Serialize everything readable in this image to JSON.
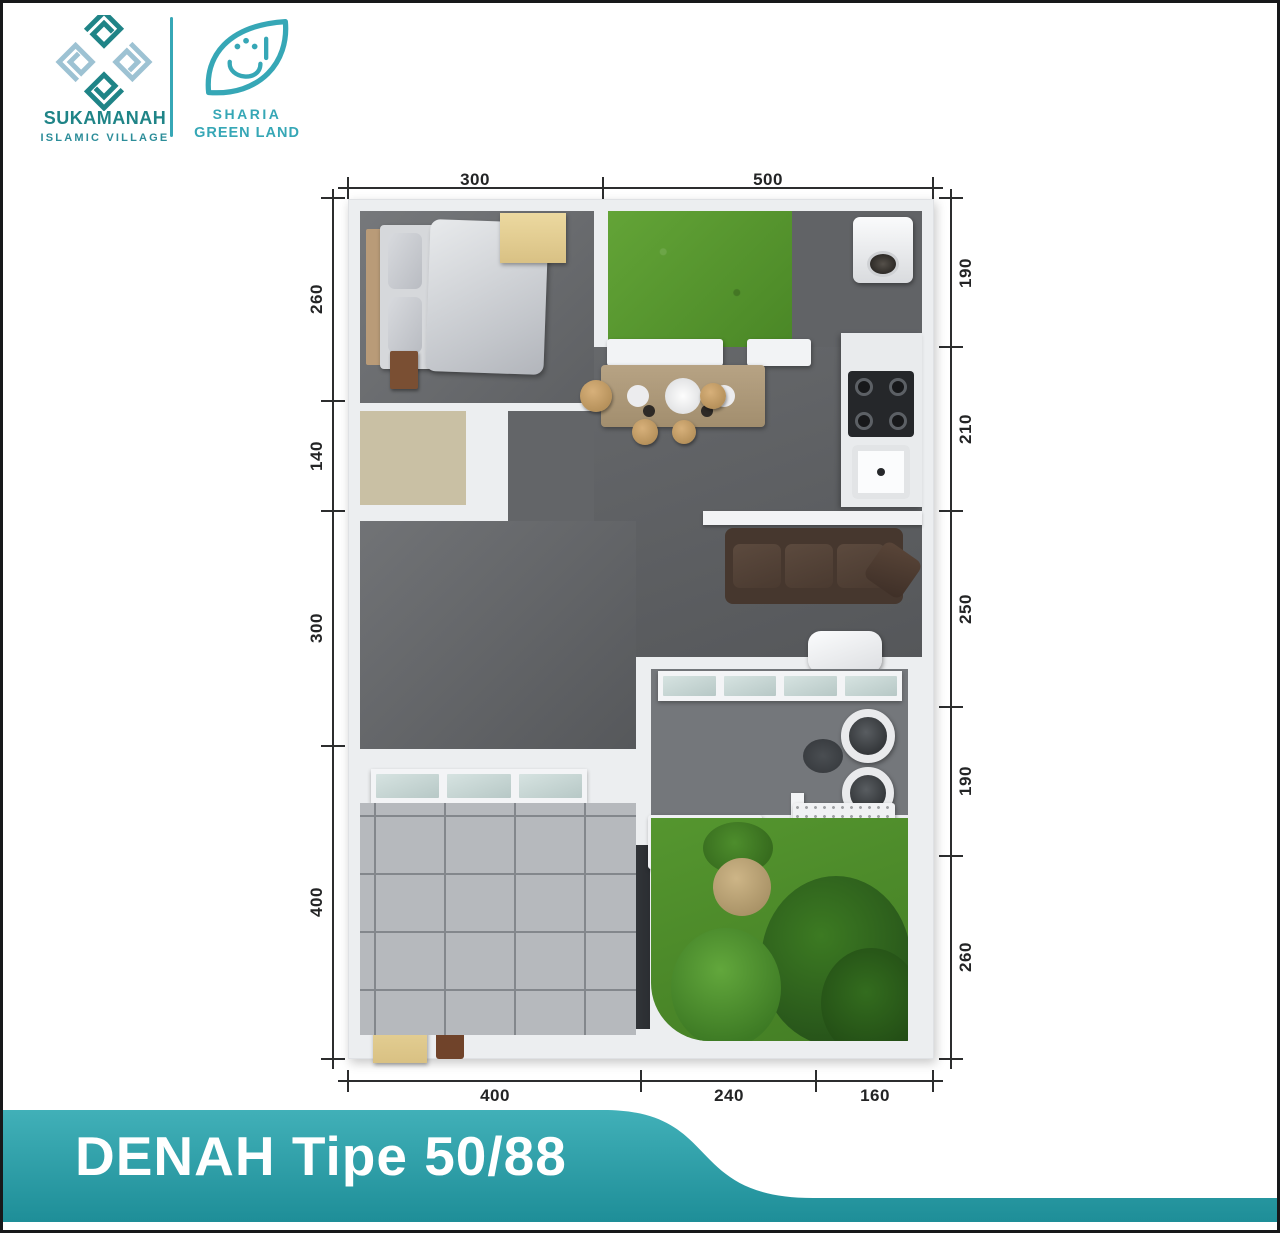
{
  "header": {
    "sukamanah": {
      "title": "SUKAMANAH",
      "subtitle": "ISLAMIC VILLAGE"
    },
    "sharia": {
      "line1": "SHARIA",
      "line2": "GREEN LAND"
    }
  },
  "floorplan": {
    "dims": {
      "top": [
        "300",
        "500"
      ],
      "left": [
        "260",
        "140",
        "300",
        "400"
      ],
      "right": [
        "190",
        "210",
        "250",
        "190",
        "260"
      ],
      "bottom": [
        "400",
        "240",
        "160"
      ]
    }
  },
  "banner": {
    "title": "DENAH Tipe 50/88"
  },
  "colors": {
    "accent": "#2a99a2",
    "banner_top": "#41b0b8",
    "banner_bot": "#1e8e98",
    "banner_text": "#ffffff",
    "logo_dark": "#1f8487",
    "logo_light": "#9dc2d3",
    "sharia_teal": "#36a7b6",
    "dim_line": "#2c2d2e",
    "wall": "#eceef0",
    "floor_dark": "#5d5f62",
    "floor_light": "#b6b9bd",
    "grass": "#569432"
  }
}
